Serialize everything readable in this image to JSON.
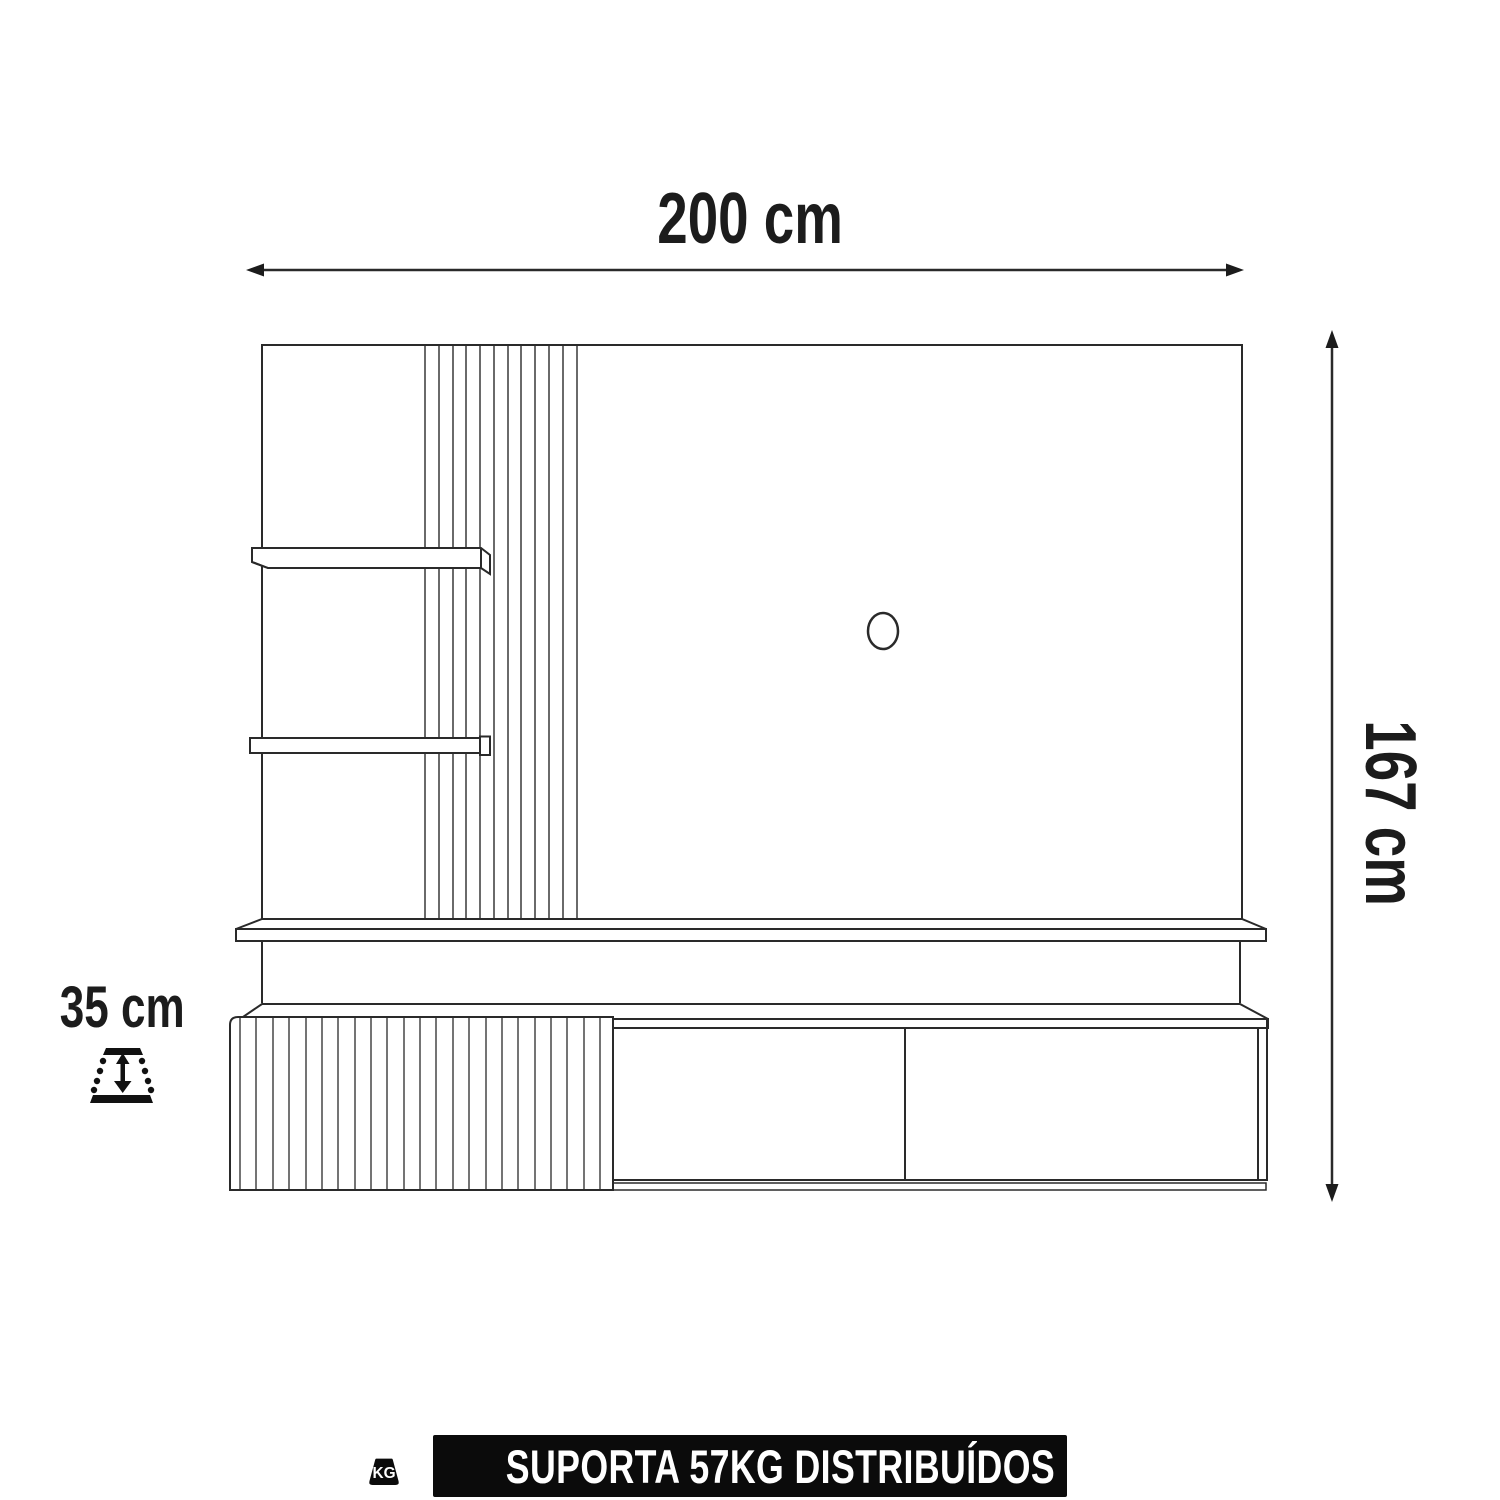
{
  "dimensions": {
    "width": {
      "label": "200 cm"
    },
    "height": {
      "label": "167 cm"
    },
    "depth": {
      "label": "35 cm"
    }
  },
  "support_banner": {
    "label": "SUPORTA 57KG DISTRIBUÍDOS",
    "weight_icon_text": "KG",
    "background": "#0b0b0b",
    "color": "#ffffff"
  },
  "diagram": {
    "background": "#ffffff",
    "line_color": "#2a2a2a",
    "icons": [
      "depth-adjust-icon",
      "kg-weight-icon",
      "cable-hole"
    ]
  }
}
